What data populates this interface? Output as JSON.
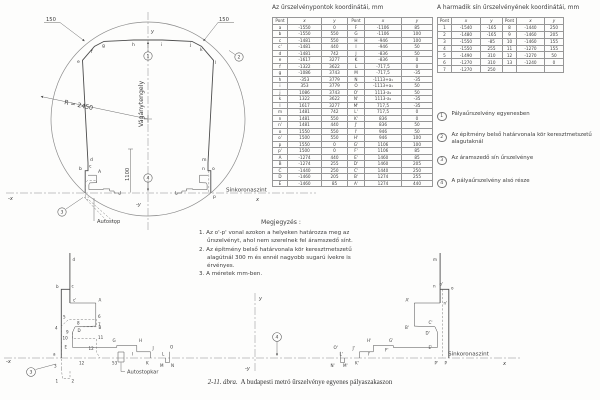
{
  "caption": {
    "figure": "2-11. ábra.",
    "text": "A budapesti metró űrszelvénye egyenes pályaszakaszon"
  },
  "table1": {
    "title": "Az űrszelvénypontok koordinátái, mm",
    "headers": [
      "Pont",
      "x",
      "y",
      "Pont",
      "x",
      "y"
    ],
    "rows": [
      [
        "a",
        "-1550",
        "0",
        "F",
        "-1106",
        "85"
      ],
      [
        "b",
        "-1550",
        "550",
        "G",
        "-1106",
        "100"
      ],
      [
        "c",
        "-1481",
        "550",
        "H",
        "-946",
        "100"
      ],
      [
        "c'",
        "-1481",
        "440",
        "I",
        "-946",
        "50"
      ],
      [
        "d",
        "-1481",
        "742",
        "J",
        "-836",
        "50"
      ],
      [
        "e",
        "-1617",
        "3277",
        "K",
        "-836",
        "0"
      ],
      [
        "f",
        "-1322",
        "3622",
        "L",
        "-717,5",
        "0"
      ],
      [
        "g",
        "-1086",
        "3743",
        "M",
        "-717,5",
        "-35"
      ],
      [
        "h",
        "-353",
        "3779",
        "N",
        "-1113+a₁",
        "-35"
      ],
      [
        "i",
        "353",
        "3779",
        "O",
        "-1113+a₁",
        "50"
      ],
      [
        "j",
        "1086",
        "3743",
        "O'",
        "1113-a₁",
        "50"
      ],
      [
        "k",
        "1322",
        "3622",
        "N'",
        "1113-a₁",
        "-35"
      ],
      [
        "l",
        "1617",
        "3277",
        "M'",
        "717,5",
        "-35"
      ],
      [
        "m",
        "1481",
        "742",
        "L'",
        "717,5",
        "0"
      ],
      [
        "n",
        "1481",
        "550",
        "K'",
        "836",
        "0"
      ],
      [
        "n'",
        "1481",
        "440",
        "J'",
        "836",
        "50"
      ],
      [
        "o",
        "1550",
        "550",
        "I'",
        "946",
        "50"
      ],
      [
        "o'",
        "1500",
        "550",
        "H'",
        "946",
        "100"
      ],
      [
        "p",
        "1550",
        "0",
        "G'",
        "1106",
        "100"
      ],
      [
        "p'",
        "1500",
        "0",
        "F'",
        "1106",
        "85"
      ],
      [
        "A",
        "-1274",
        "440",
        "E'",
        "1460",
        "85"
      ],
      [
        "B",
        "-1274",
        "255",
        "D'",
        "1460",
        "205"
      ],
      [
        "C",
        "-1440",
        "250",
        "C'",
        "1440",
        "250"
      ],
      [
        "D",
        "-1460",
        "205",
        "B'",
        "1274",
        "255"
      ],
      [
        "E",
        "-1460",
        "85",
        "A'",
        "1274",
        "440"
      ]
    ]
  },
  "table2": {
    "title": "A harmadik sín űrszelvényének koordinátái, mm",
    "headers": [
      "Pont",
      "x",
      "y",
      "Pont",
      "x",
      "y"
    ],
    "rows": [
      [
        "1",
        "-1540",
        "-165",
        "8",
        "-1440",
        "250"
      ],
      [
        "2",
        "-1480",
        "-165",
        "9",
        "-1460",
        "205"
      ],
      [
        "3",
        "-1550",
        "-85",
        "10",
        "-1460",
        "155"
      ],
      [
        "4",
        "-1550",
        "255",
        "11",
        "-1270",
        "155"
      ],
      [
        "5",
        "-1490",
        "310",
        "12",
        "-1270",
        "50"
      ],
      [
        "6",
        "-1270",
        "310",
        "13",
        "-1240",
        "0"
      ],
      [
        "7",
        "-1270",
        "250",
        "",
        "",
        ""
      ]
    ]
  },
  "legend": {
    "items": [
      {
        "num": "1",
        "text": "Pályaűrszelvény egyenesben"
      },
      {
        "num": "2",
        "text": "Az építmény belső határvonala kör keresztmetszetű alagutaknál"
      },
      {
        "num": "3",
        "text": "Az áramszedő sín űrszelvénye"
      },
      {
        "num": "4",
        "text": "A pályaűrszelvény alsó része"
      }
    ]
  },
  "notes": {
    "title": "Megjegyzés :",
    "lines": [
      "1. Az o'-p' vonal azokon a helyeken határozza meg az",
      "űrszelvényt, ahol nem szerelnek fel áramszedő sínt.",
      "2. Az építmény belső határvonala kör keresztmetszetű",
      "alagútnál 300 m és ennél nagyobb sugarú ívekre is",
      "érvényes.",
      "3. A méretek mm-ben."
    ]
  },
  "main": {
    "radius_label": "R = 2450",
    "track_axis": "Vágánytengely",
    "rail_level": "Sínkoronaszint",
    "autostop": "Autostop",
    "dim150_left": "150",
    "dim150_right": "150",
    "dim1100": "1100",
    "axis": {
      "y": "y",
      "my": "-y",
      "mx": "-x",
      "x": "x"
    },
    "callouts": {
      "c1": "1",
      "c2": "2",
      "c3": "3",
      "c4": "4"
    },
    "pts": {
      "b": "b",
      "c": "c",
      "d": "d",
      "e": "e",
      "f": "f",
      "g": "g",
      "h": "h",
      "i": "i",
      "j": "j",
      "k": "k",
      "l": "l",
      "m": "m",
      "n": "n",
      "o": "o",
      "p": "p",
      "A": "A"
    }
  },
  "detail": {
    "rail_level": "Sínkoronaszint",
    "autostop": "Autostopkar",
    "dim53": "53",
    "dim12": "12",
    "axis": {
      "y": "y",
      "my": "-y",
      "mx": "-x",
      "x": "x"
    },
    "callouts": {
      "c3": "3",
      "c4": "4"
    },
    "l": {
      "a": "a",
      "b": "b",
      "c": "c",
      "cp": "c'",
      "d": "d",
      "A": "A",
      "B": "B",
      "D": "D",
      "E": "E",
      "G": "G",
      "H": "H",
      "I": "I",
      "J": "J",
      "K": "K",
      "L": "L",
      "M": "M",
      "N": "N",
      "O": "O",
      "p1": "1",
      "p2": "2",
      "p3": "3",
      "p4": "4",
      "p5": "5",
      "p6": "6",
      "p7": "7",
      "p8": "8",
      "p9": "9",
      "p10": "10",
      "p11": "11",
      "p12": "12"
    },
    "r": {
      "m": "m",
      "n": "n",
      "np": "n'",
      "o": "o",
      "op": "o'",
      "Op": "O'",
      "A": "A'",
      "B": "B'",
      "C": "C'",
      "D": "D'",
      "E": "E'",
      "F": "F'",
      "G": "G'",
      "H": "H'",
      "I": "I'",
      "J": "J'",
      "K": "K'",
      "L": "L'",
      "M": "M'",
      "N": "N'",
      "P": "P",
      "Pp": "P'"
    }
  }
}
